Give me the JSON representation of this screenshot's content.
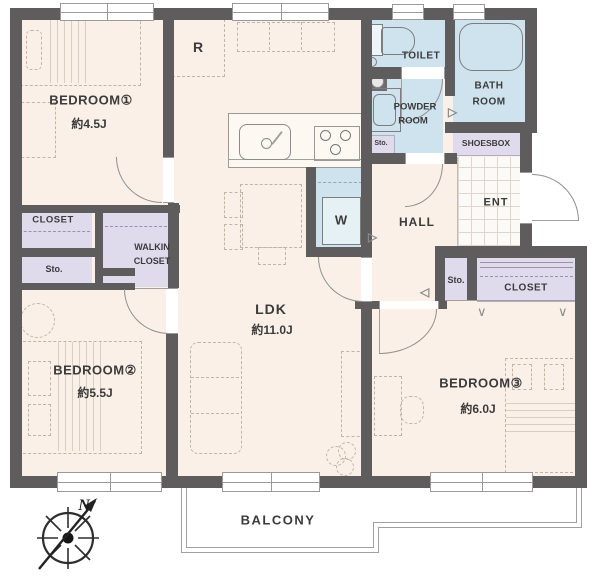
{
  "floorplan": {
    "rooms": {
      "bedroom1": {
        "name": "BEDROOM①",
        "size": "約4.5J"
      },
      "bedroom2": {
        "name": "BEDROOM②",
        "size": "約5.5J"
      },
      "bedroom3": {
        "name": "BEDROOM③",
        "size": "約6.0J"
      },
      "ldk": {
        "name": "LDK",
        "size": "約11.0J"
      },
      "toilet": {
        "name": "TOILET"
      },
      "bathroom": {
        "line1": "BATH",
        "line2": "ROOM"
      },
      "powder_room": {
        "line1": "POWDER",
        "line2": "ROOM"
      },
      "hall": {
        "name": "HALL"
      },
      "entrance": {
        "name": "ENT"
      },
      "balcony": {
        "name": "BALCONY"
      }
    },
    "storage": {
      "closet_bedroom1": "CLOSET",
      "storage_bedroom1": "Sto.",
      "walkin_line1": "WALKIN",
      "walkin_line2": "CLOSET",
      "storage_powder": "Sto.",
      "shoesbox": "SHOESBOX",
      "storage_hall": "Sto.",
      "closet_bedroom3": "CLOSET"
    },
    "fixtures": {
      "refrigerator": "R",
      "washer": "W"
    },
    "compass": {
      "north": "N"
    },
    "colors": {
      "wall": "#5e5c5d",
      "floor": "#faf0e8",
      "wet_area": "#cfe3ee",
      "storage_area": "#dfdbec",
      "outline": "#9a9a9a"
    }
  }
}
